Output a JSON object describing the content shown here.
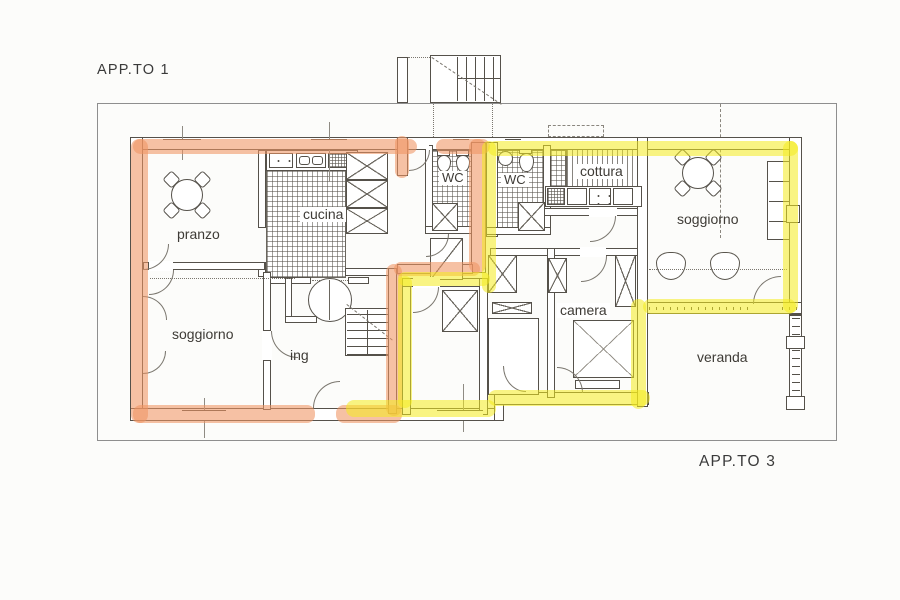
{
  "plan": {
    "labels": {
      "apartment_1": "APP.TO 1",
      "apartment_3": "APP.TO 3"
    },
    "rooms": {
      "pranzo": "pranzo",
      "cucina": "cucina",
      "soggiorno_left": "soggiorno",
      "ing": "ing",
      "wc_1": "WC",
      "wc_2": "WC",
      "cottura": "cottura",
      "soggiorno_right": "soggiorno",
      "camera": "camera",
      "veranda": "veranda"
    },
    "colors": {
      "apartment_1_highlight": "#F09463",
      "apartment_3_highlight": "#F4EB1E",
      "wall_ink": "#55514A",
      "outer_border": "#8E8E8E",
      "paper": "#FCFCFA"
    }
  }
}
